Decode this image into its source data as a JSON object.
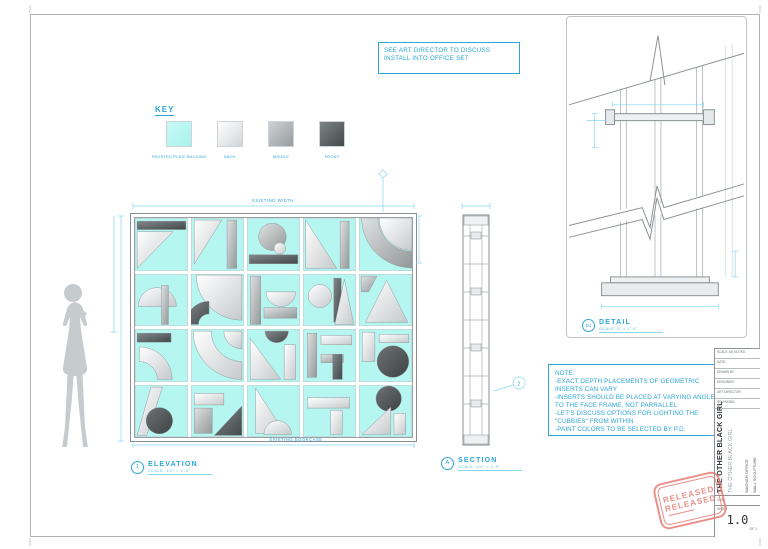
{
  "page": {
    "accent_color": "#2ba6d6",
    "dim_color": "#86d7f0",
    "plexi_color": "#b5f6f0",
    "stamp_color": "#e4756d"
  },
  "art_note": {
    "text": "SEE ART DIRECTOR TO DISCUSS INSTALL INTO OFFICE SET"
  },
  "key": {
    "title": "KEY",
    "swatches": [
      {
        "label": "FROSTED PLEXI BACKING",
        "type": "cyan"
      },
      {
        "label": "BACK",
        "type": "light"
      },
      {
        "label": "MIDDLE",
        "type": "mid"
      },
      {
        "label": "FRONT",
        "type": "dark"
      }
    ]
  },
  "elevation": {
    "marker": "1",
    "title": "ELEVATION",
    "scale": "SCALE: 1/2\" = 1'-0\"",
    "dim_top": "EXISTING WIDTH",
    "dim_bottom": "EXISTING BOOKCASE",
    "cells": [
      [
        [
          "r",
          "d",
          4,
          6,
          92,
          16
        ],
        [
          "p",
          "l",
          "4,26 72,26 4,96"
        ]
      ],
      [
        [
          "p",
          "l",
          "6,4 58,4 6,88"
        ],
        [
          "r",
          "m",
          68,
          4,
          18,
          92
        ]
      ],
      [
        [
          "c",
          "m",
          48,
          36,
          26
        ],
        [
          "c",
          "l",
          62,
          58,
          11
        ],
        [
          "r",
          "d",
          4,
          70,
          92,
          17
        ]
      ],
      [
        [
          "p",
          "l",
          "5,4 5,96 64,96"
        ],
        [
          "r",
          "m",
          70,
          6,
          17,
          90
        ]
      ],
      [
        [
          "w",
          "l",
          100,
          0,
          62,
          90,
          180
        ],
        [
          "n",
          "m",
          100,
          0,
          95,
          64,
          90,
          180
        ]
      ],
      [
        [
          "s",
          "l",
          42,
          62,
          36,
          180
        ],
        [
          "r",
          "m",
          50,
          22,
          13,
          74
        ]
      ],
      [
        [
          "w",
          "l",
          96,
          2,
          86,
          90,
          180
        ],
        [
          "n",
          "d",
          34,
          96,
          44,
          20,
          180,
          270
        ]
      ],
      [
        [
          "r",
          "m",
          6,
          4,
          20,
          92
        ],
        [
          "s",
          "l",
          64,
          34,
          28,
          0
        ],
        [
          "r",
          "m",
          32,
          64,
          62,
          20
        ]
      ],
      [
        [
          "c",
          "l",
          32,
          42,
          22
        ],
        [
          "r",
          "d",
          58,
          8,
          14,
          84
        ],
        [
          "p",
          "l",
          "78,10 96,96 60,96"
        ]
      ],
      [
        [
          "p",
          "m",
          "4,4 34,4 18,34 4,34"
        ],
        [
          "p",
          "l",
          "52,12 92,92 12,92"
        ]
      ],
      [
        [
          "r",
          "d",
          4,
          8,
          64,
          17
        ],
        [
          "n",
          "l",
          8,
          96,
          62,
          34,
          270,
          360
        ]
      ],
      [
        [
          "w",
          "l",
          96,
          4,
          34,
          90,
          180
        ],
        [
          "n",
          "l",
          96,
          4,
          92,
          58,
          90,
          180
        ]
      ],
      [
        [
          "s",
          "d",
          56,
          4,
          22,
          0
        ],
        [
          "p",
          "l",
          "6,18 6,96 64,96"
        ],
        [
          "r",
          "l",
          70,
          30,
          22,
          66
        ]
      ],
      [
        [
          "r",
          "m",
          8,
          8,
          18,
          84
        ],
        [
          "r",
          "l",
          34,
          12,
          58,
          18
        ],
        [
          "r",
          "m",
          34,
          48,
          42,
          16
        ],
        [
          "r",
          "d",
          56,
          48,
          18,
          48
        ]
      ],
      [
        [
          "r",
          "l",
          6,
          6,
          24,
          56
        ],
        [
          "r",
          "l",
          38,
          10,
          56,
          16
        ],
        [
          "c",
          "dd",
          64,
          62,
          30
        ]
      ],
      [
        [
          "p",
          "l",
          "30,4 52,4 22,96 4,96"
        ],
        [
          "c",
          "dd",
          46,
          68,
          25
        ]
      ],
      [
        [
          "r",
          "l",
          6,
          16,
          56,
          22
        ],
        [
          "r",
          "m",
          6,
          44,
          34,
          48
        ],
        [
          "p",
          "d",
          "44,96 96,40 96,96"
        ]
      ],
      [
        [
          "p",
          "l",
          "16,6 16,92 72,92"
        ],
        [
          "s",
          "l",
          58,
          94,
          26,
          180
        ]
      ],
      [
        [
          "r",
          "l",
          8,
          24,
          80,
          20
        ],
        [
          "r",
          "l",
          52,
          48,
          22,
          46
        ]
      ],
      [
        [
          "c",
          "dd",
          56,
          26,
          24
        ],
        [
          "p",
          "l",
          "6,94 60,42 60,94"
        ],
        [
          "r",
          "l",
          66,
          54,
          22,
          40
        ]
      ]
    ]
  },
  "section": {
    "marker": "A",
    "title": "SECTION",
    "scale": "SCALE: 1/2\" = 1'-0\"",
    "callout": "2"
  },
  "detail": {
    "marker": "D1",
    "title": "DETAIL",
    "scale": "SCALE: 3\" = 1'-0\""
  },
  "notes": {
    "heading": "NOTE:",
    "lines": [
      "-EXACT DEPTH PLACEMENTS OF GEOMETRIC INSERTS CAN VARY",
      "-INSERTS SHOULD BE PLACED AT VARYING ANGLES TO THE FACE FRAME, NOT PARRALLEL",
      "-LET'S DISCUSS OPTIONS FOR LIGHTING THE \"CUBBIES\" FROM WITHIN",
      "-PAINT COLORS TO BE SELECTED BY P.D."
    ]
  },
  "title_block": {
    "show": "THE OTHER BLACK GIRL",
    "show_sub": "THE OTHER BLACK GIRL",
    "set_name": "WAGNER OFFICE",
    "drawing_name": "WALL SCULPTURE",
    "fields": [
      "SCALE: AS NOTED",
      "DATE:",
      "DRAWN BY:",
      "DESIGNER:",
      "ART DIRECTOR:",
      "REVISIONS:"
    ],
    "scale_cell": "1:20",
    "sheet_label": "SHEET",
    "sheet_number": "1.0",
    "sheet_of": "OF 1"
  },
  "stamp": {
    "line1": "RELEASED",
    "line2": "RELEASED"
  }
}
